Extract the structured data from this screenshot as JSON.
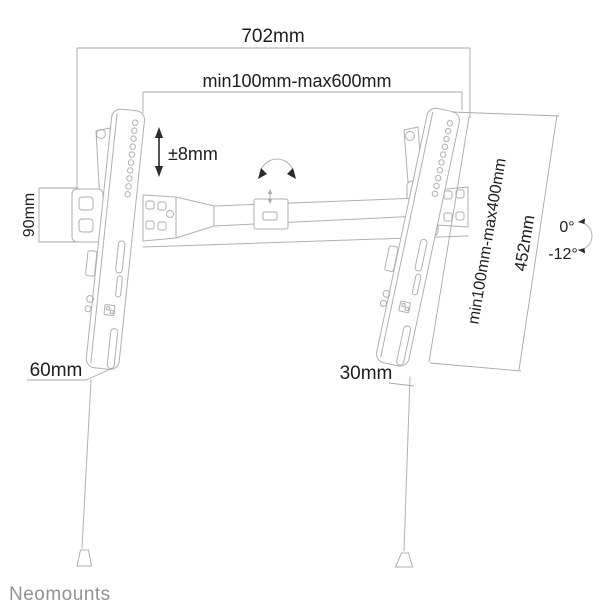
{
  "diagram": {
    "labels": {
      "total_width": "702mm",
      "vesa_width_range": "min100mm-max600mm",
      "height_adjustment": "±8mm",
      "wall_plate_height": "90mm",
      "vesa_height_range": "min100mm-max400mm",
      "bracket_length": "452mm",
      "tilt_upper": "0°",
      "tilt_lower": "-12°",
      "bottom_left_offset": "60mm",
      "bottom_right_offset": "30mm"
    },
    "brand": "Neomounts",
    "colors": {
      "drawing_line": "#aeb0b2",
      "dimension_line": "#a6a8aa",
      "label_text": "#1d1d1f",
      "brand_text": "#929295",
      "background": "#ffffff"
    }
  }
}
